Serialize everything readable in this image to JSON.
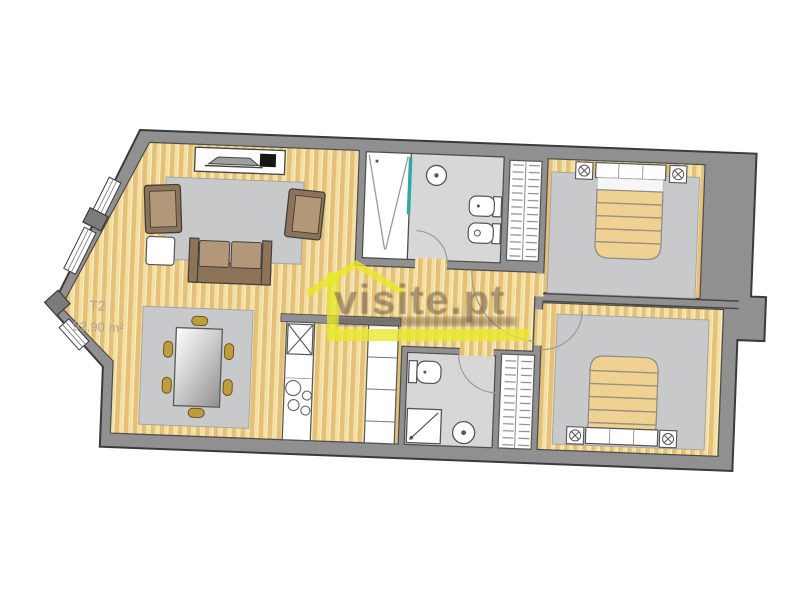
{
  "image": {
    "type": "apartment-floor-plan",
    "description": "2D architectural floor plan of a T2 apartment, slightly rotated, with watermark overlay",
    "background": "#ffffff"
  },
  "plan": {
    "unit_label": "T2",
    "area_label": "92.90 m²"
  },
  "watermark": {
    "text": "visite.pt",
    "logo": "yellow-house-roof-icon",
    "underline": "yellow-bar"
  },
  "palette": {
    "wall": "#909090",
    "wall_outline": "#3a3a3a",
    "wood_light": "#f4dfa2",
    "wood_dark": "#e4c078",
    "floor_tile": "#d7d7d7",
    "rug": "#c8c9ca",
    "sofa_frame": "#8d7458",
    "sofa_cushion": "#b29878",
    "chair_gold": "#bf9c3f",
    "bed_blanket": "#efd192",
    "shower_glass": "#2fa8a2",
    "watermark_yellow": "#e8e82b",
    "watermark_text": "#6a5a4a",
    "label": "#b3a591"
  },
  "rooms": [
    {
      "name": "living-room",
      "items": [
        "tv-console",
        "tv-icon",
        "media-box-icon",
        "rug",
        "armchair",
        "armchair",
        "sofa",
        "side-table"
      ]
    },
    {
      "name": "dining-area",
      "items": [
        "rug",
        "dining-table",
        "chair",
        "chair",
        "chair",
        "chair",
        "chair",
        "chair"
      ]
    },
    {
      "name": "kitchen",
      "items": [
        "counter-column",
        "sink-icon",
        "cooktop-icon",
        "cabinet-column"
      ]
    },
    {
      "name": "bathroom-top",
      "items": [
        "shower-icon",
        "washbasin-icon",
        "toilet-icon",
        "bidet-icon"
      ]
    },
    {
      "name": "bathroom-bottom",
      "items": [
        "toilet-icon",
        "shower-icon",
        "washbasin-icon"
      ]
    },
    {
      "name": "bedroom-top-right",
      "items": [
        "double-bed",
        "nightstand-lamp-icon",
        "nightstand-lamp-icon",
        "wardrobe",
        "rug"
      ]
    },
    {
      "name": "bedroom-bottom-right",
      "items": [
        "double-bed",
        "nightstand-lamp-icon",
        "nightstand-lamp-icon",
        "wardrobe",
        "rug"
      ]
    }
  ]
}
